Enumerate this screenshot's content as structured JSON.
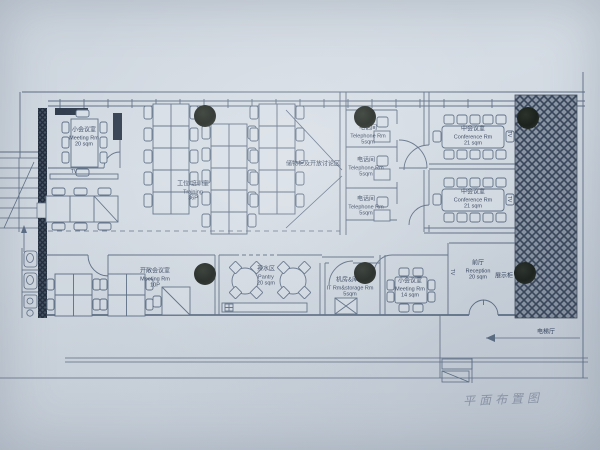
{
  "plan": {
    "handwritten_title": "平面布置图",
    "rooms": {
      "meeting20": {
        "cn": "小会议室",
        "en": "Meeting Rm",
        "area": "20 sqm"
      },
      "training": {
        "cn": "工位/培训室",
        "en": "Training",
        "area": "36P"
      },
      "open_discussion": {
        "cn": "储物柜及开放讨论区"
      },
      "tel1": {
        "cn": "电话间",
        "en": "Telephone Rm",
        "area": "5sqm"
      },
      "tel2": {
        "cn": "电话间",
        "en": "Telephone Rm",
        "area": "5sqm"
      },
      "tel3": {
        "cn": "电话间",
        "en": "Telephone Rm",
        "area": "5sqm"
      },
      "conf1": {
        "cn": "中会议室",
        "en": "Conference Rm",
        "area": "21 sqm"
      },
      "conf2": {
        "cn": "中会议室",
        "en": "Conference Rm",
        "area": "21 sqm"
      },
      "openMeeting": {
        "cn": "开敞会议室",
        "en": "Meeting Rm",
        "area": "10P"
      },
      "pantry": {
        "cn": "茶水区",
        "en": "Pantry",
        "area": "20 sqm"
      },
      "it": {
        "cn": "机房&库房",
        "en": "IT Rm&storage Rm",
        "area": "5sqm"
      },
      "meeting14": {
        "cn": "小会议室",
        "en": "Meeting Rm",
        "area": "14 sqm"
      },
      "reception": {
        "cn": "前厅",
        "en": "Reception",
        "area": "20 sqm"
      }
    },
    "annotations": {
      "display_cabinet": "展示柜",
      "elevator_hall": "电梯厅",
      "tv": "TV"
    },
    "colors": {
      "paper": "#cfd7e0",
      "line": "#5d6e85",
      "text": "#36465f",
      "hatch_dark": "#39455a",
      "wall_dark": "#303c4d",
      "magnet_dot": "#1e241e"
    }
  }
}
